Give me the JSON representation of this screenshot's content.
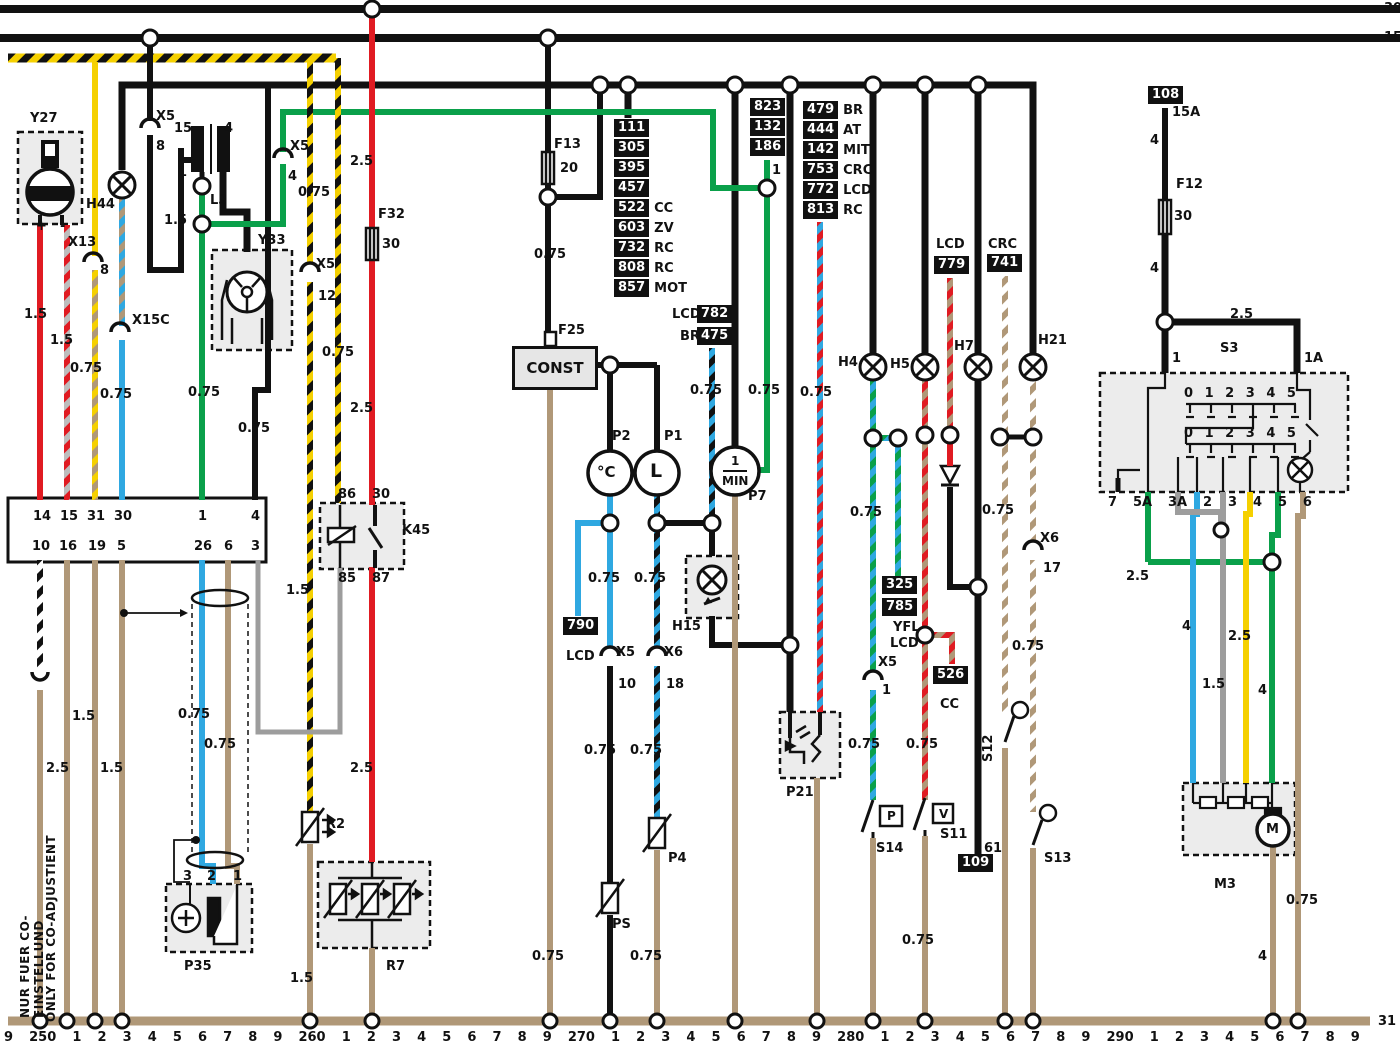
{
  "rails": {
    "r30": "30",
    "r15": "15",
    "r31": "31"
  },
  "bottom_ticks": [
    "9",
    "250",
    "1",
    "2",
    "3",
    "4",
    "5",
    "6",
    "7",
    "8",
    "9",
    "260",
    "1",
    "2",
    "3",
    "4",
    "5",
    "6",
    "7",
    "8",
    "9",
    "270",
    "1",
    "2",
    "3",
    "4",
    "5",
    "6",
    "7",
    "8",
    "9",
    "280",
    "1",
    "2",
    "3",
    "4",
    "5",
    "6",
    "7",
    "8",
    "9",
    "290",
    "1",
    "2",
    "3",
    "4",
    "5",
    "6",
    "7",
    "8",
    "9"
  ],
  "components": {
    "y27": "Y27",
    "h44": "H44",
    "l3": "L3",
    "y33": "Y33",
    "f13": "F13",
    "f32": "F32",
    "f25": "F25",
    "f12": "F12",
    "k45": "K45",
    "p35": "P35",
    "r2": "R2",
    "r7": "R7",
    "ps": "PS",
    "p4": "P4",
    "p2": "P2",
    "p1": "P1",
    "p7": "P7",
    "h15": "H15",
    "p21": "P21",
    "h4": "H4",
    "h5": "H5",
    "h7": "H7",
    "h21": "H21",
    "s14": "S14",
    "s11": "S11",
    "s12": "S12",
    "s13": "S13",
    "s3": "S3",
    "m3": "M3"
  },
  "connectors": {
    "x5": "X5",
    "x6": "X6",
    "x13": "X13",
    "x15c": "X15C"
  },
  "wg": {
    "w075": "0.75",
    "w15": "1.5",
    "w25": "2.5",
    "w4": "4"
  },
  "fuses": {
    "f13a": "20",
    "f32a": "30",
    "f12a": "30",
    "f108a": "15A"
  },
  "nums": {
    "n0": "0",
    "n1": "1",
    "n1a": "1A",
    "n2": "2",
    "n3": "3",
    "n4": "4",
    "n5": "5",
    "n6": "6",
    "n7": "7",
    "n8": "8",
    "n10": "10",
    "n12": "12",
    "n14": "14",
    "n15": "15",
    "n16": "16",
    "n17": "17",
    "n18": "18",
    "n19": "19",
    "n26": "26",
    "n30": "30",
    "n31": "31",
    "n61": "61",
    "n85": "85",
    "n86": "86",
    "n87": "87"
  },
  "ref": {
    "b108": "108",
    "b109": "109",
    "b741": "741",
    "b779": "779",
    "b526": "526",
    "b790": "790",
    "b782": "782",
    "b475": "475",
    "b325": "325",
    "b785": "785",
    "b823": [
      "823",
      "132",
      "186"
    ],
    "b111": [
      {
        "n": "111",
        "s": ""
      },
      {
        "n": "305",
        "s": ""
      },
      {
        "n": "395",
        "s": ""
      },
      {
        "n": "457",
        "s": ""
      },
      {
        "n": "522",
        "s": "CC"
      },
      {
        "n": "603",
        "s": "ZV"
      },
      {
        "n": "732",
        "s": "RC"
      },
      {
        "n": "808",
        "s": "RC"
      },
      {
        "n": "857",
        "s": "MOT"
      }
    ],
    "b479": [
      {
        "n": "479",
        "s": "BR"
      },
      {
        "n": "444",
        "s": "AT"
      },
      {
        "n": "142",
        "s": "MIT"
      },
      {
        "n": "753",
        "s": "CRC"
      },
      {
        "n": "772",
        "s": "LCD"
      },
      {
        "n": "813",
        "s": "RC"
      }
    ]
  },
  "variant": {
    "br": "BR",
    "crc": "CRC",
    "lcd": "LCD",
    "yfl": "YFL",
    "cc": "CC"
  },
  "misc": {
    "plus": "+",
    "minus": "-",
    "degc": "°C",
    "l": "L",
    "min_num": "1",
    "min_den": "MIN",
    "m": "M",
    "p": "P",
    "v": "V",
    "const": "CONST",
    "note_de": "NUR FUER CO-EINSTELLUND",
    "note_en": "ONLY FOR CO-ADJUSTIENT"
  },
  "s3": {
    "positions": [
      "0",
      "1",
      "2",
      "3",
      "4",
      "5"
    ],
    "pins": [
      "7",
      "5A",
      "3A",
      "2",
      "3",
      "4",
      "5",
      "6"
    ]
  },
  "cluster": {
    "top": [
      "14",
      "15",
      "31",
      "30",
      "1",
      "4"
    ],
    "bottom": [
      "10",
      "16",
      "19",
      "5",
      "26",
      "6",
      "3"
    ]
  },
  "colors": {
    "black": "#111111",
    "red": "#e01b22",
    "green": "#0aa04a",
    "blue": "#2fa8e1",
    "yellow": "#f5d000",
    "tan": "#b09878",
    "gray": "#9d9d9d",
    "boxfill": "#ececec"
  }
}
